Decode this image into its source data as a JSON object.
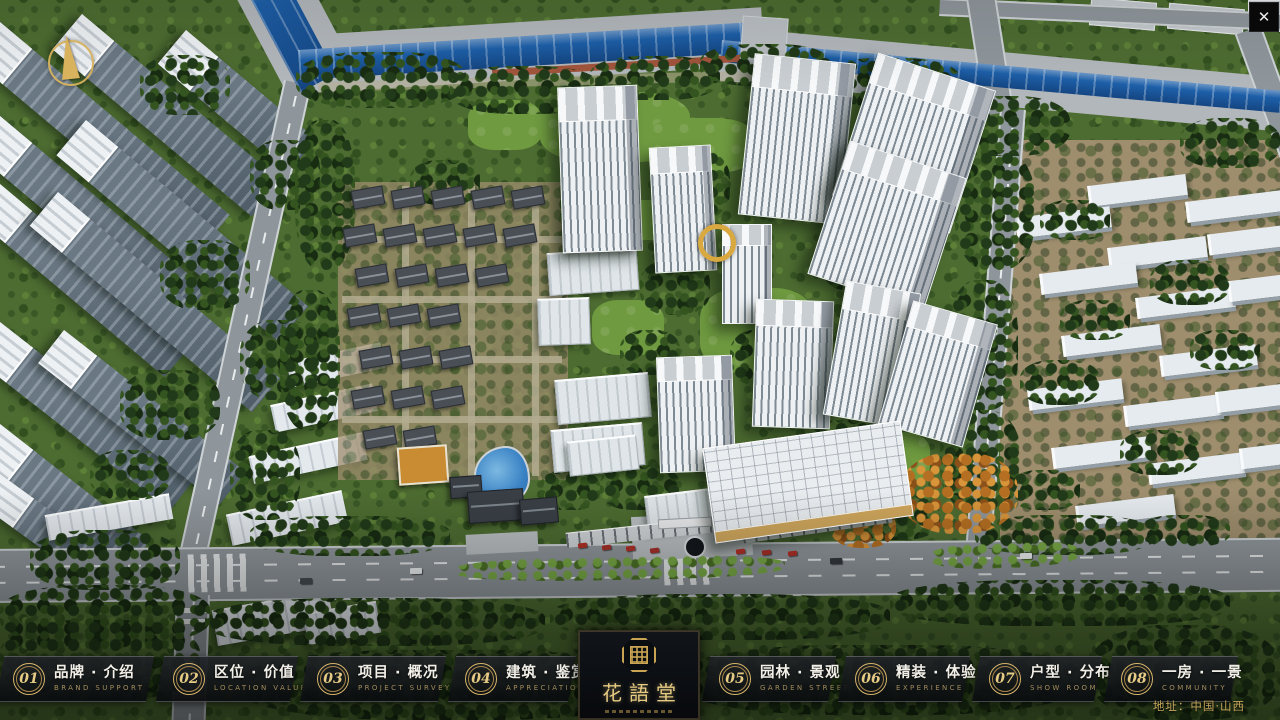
{
  "window": {
    "close_label": "✕"
  },
  "logo": {
    "title": "花語堂"
  },
  "footer": {
    "address": "地址：中国·山西"
  },
  "menu": {
    "items": [
      {
        "num": "01",
        "zh": "品牌 · 介绍",
        "en": "BRAND SUPPORT"
      },
      {
        "num": "02",
        "zh": "区位 · 价值",
        "en": "LOCATION VALUE"
      },
      {
        "num": "03",
        "zh": "项目 · 概况",
        "en": "PROJECT SURVEY"
      },
      {
        "num": "04",
        "zh": "建筑 · 鉴赏",
        "en": "APPRECIATION"
      },
      {
        "num": "05",
        "zh": "园林 · 景观",
        "en": "GARDEN STREET"
      },
      {
        "num": "06",
        "zh": "精装 · 体验",
        "en": "EXPERIENCE"
      },
      {
        "num": "07",
        "zh": "户型 · 分布",
        "en": "SHOW ROOM"
      },
      {
        "num": "08",
        "zh": "一房 · 一景",
        "en": "COMMUNITY"
      }
    ]
  },
  "colors": {
    "gold": "#c9a452",
    "bar_dark": "#101419",
    "river_blue": "#1d5fa8",
    "tree_green": "#34551f",
    "road_gray": "#8f969b"
  }
}
